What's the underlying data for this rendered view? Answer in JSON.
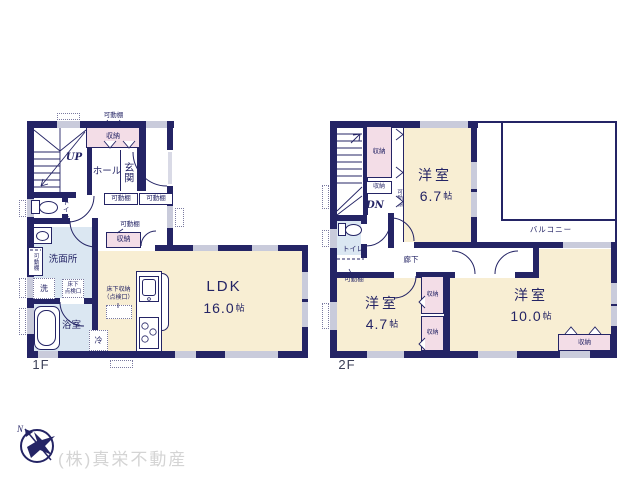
{
  "terms": {
    "movable_shelf": "可動棚",
    "storage": "収納",
    "up": "UP",
    "down": "DN",
    "hall": "ホール",
    "entrance": "玄関",
    "toilet": "トイレ",
    "washroom": "洗面所",
    "laundry": "洗",
    "underfloor_hatch_line1": "床下",
    "underfloor_hatch_line2": "点検口",
    "bathroom": "浴室",
    "underfloor_storage_line1": "床下収納",
    "underfloor_storage_line2": "（点検口）",
    "fridge": "冷",
    "corridor": "廊下",
    "balcony": "バルコニー",
    "western_room": "洋室",
    "size_unit": "帖"
  },
  "floor1": {
    "label": "1F",
    "ldk_name": "LDK",
    "ldk_size": "16.0"
  },
  "floor2": {
    "label": "2F",
    "room_67_size": "6.7",
    "room_47_size": "4.7",
    "room_100_size": "10.0"
  },
  "footer": {
    "company": "(株)真栄不動産",
    "compass_north": "N"
  },
  "colors": {
    "wall": "#242465",
    "room_cream": "#f8eed3",
    "storage_pink": "#f3dde7",
    "wet_blue": "#dbe7f2",
    "window": "#c9cbdb",
    "footer_text": "#d4d4d4"
  }
}
